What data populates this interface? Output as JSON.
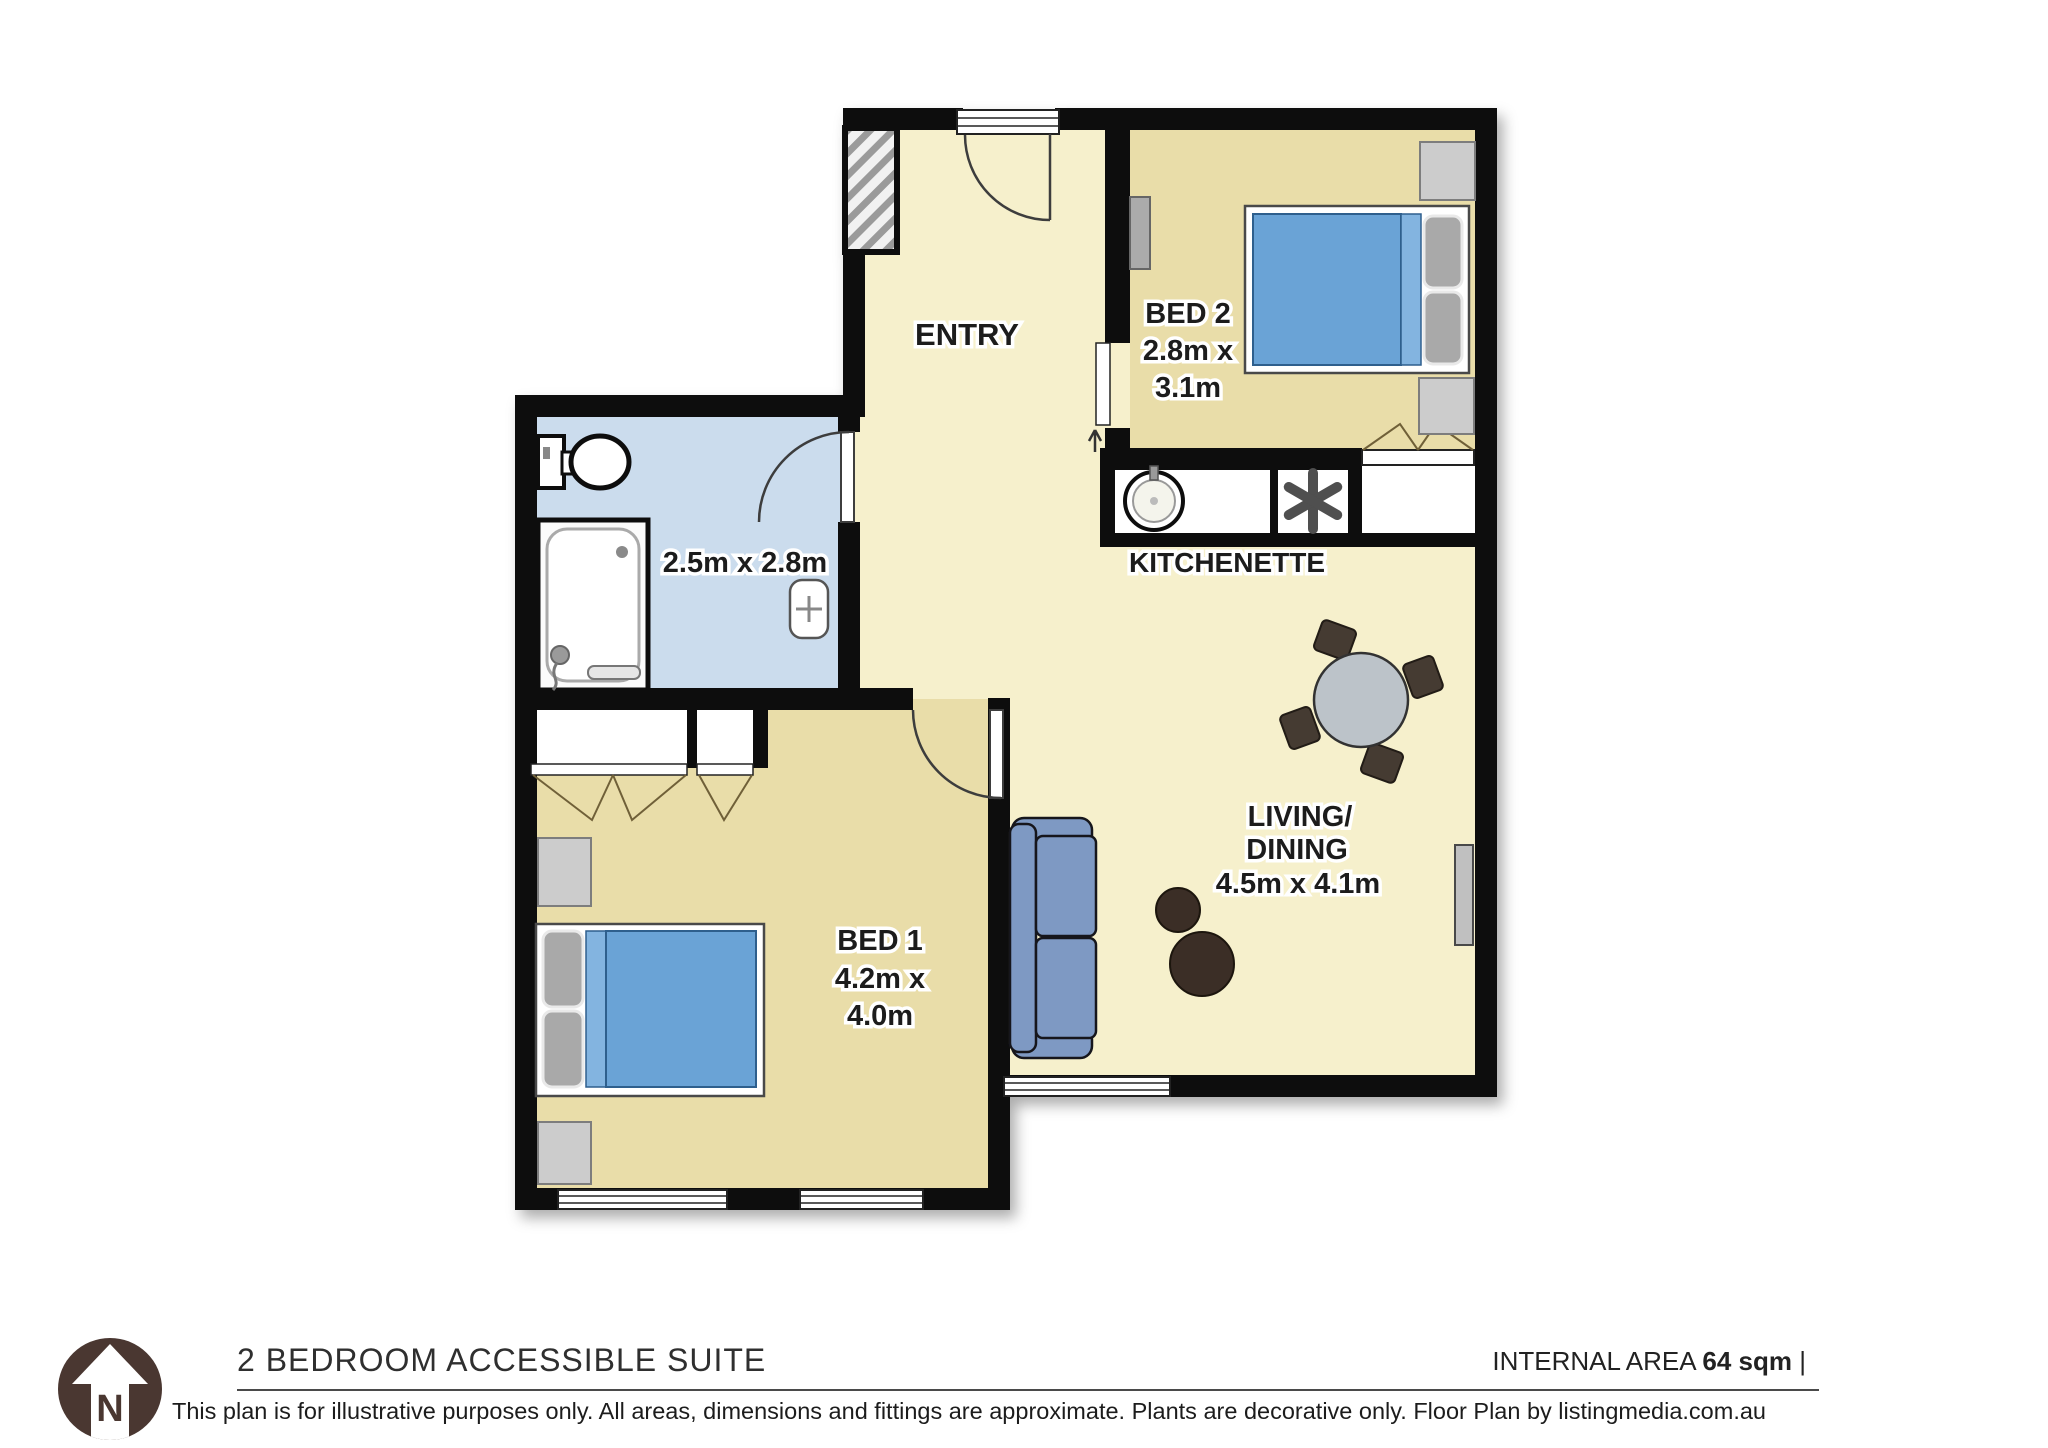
{
  "plan": {
    "rooms": {
      "entry": {
        "label": "ENTRY"
      },
      "bed2": {
        "label": "BED 2",
        "dim_line1": "2.8m x",
        "dim_line2": "3.1m"
      },
      "kitchenette": {
        "label": "KITCHENETTE"
      },
      "bathroom": {
        "dims": "2.5m x 2.8m"
      },
      "bed1": {
        "label": "BED 1",
        "dim_line1": "4.2m x",
        "dim_line2": "4.0m"
      },
      "living": {
        "label_line1": "LIVING/",
        "label_line2": "DINING",
        "dims": "4.5m x 4.1m"
      }
    },
    "colors": {
      "floor_main": "#f6f0cc",
      "floor_bedroom": "#e9dda9",
      "floor_bathroom": "#cbdced",
      "wall": "#101010",
      "bed_blue": "#6ba3d6",
      "sofa_blue": "#7e99c3",
      "logo_brown": "#4a3731"
    }
  },
  "footer": {
    "title": "2 BEDROOM ACCESSIBLE SUITE",
    "internal_area_label": "INTERNAL AREA",
    "internal_area_value": "64 sqm",
    "separator": "|",
    "disclaimer": "This plan is for illustrative purposes only. All areas, dimensions and fittings are approximate. Plants are decorative only. Floor Plan by listingmedia.com.au",
    "logo_letter": "N"
  }
}
